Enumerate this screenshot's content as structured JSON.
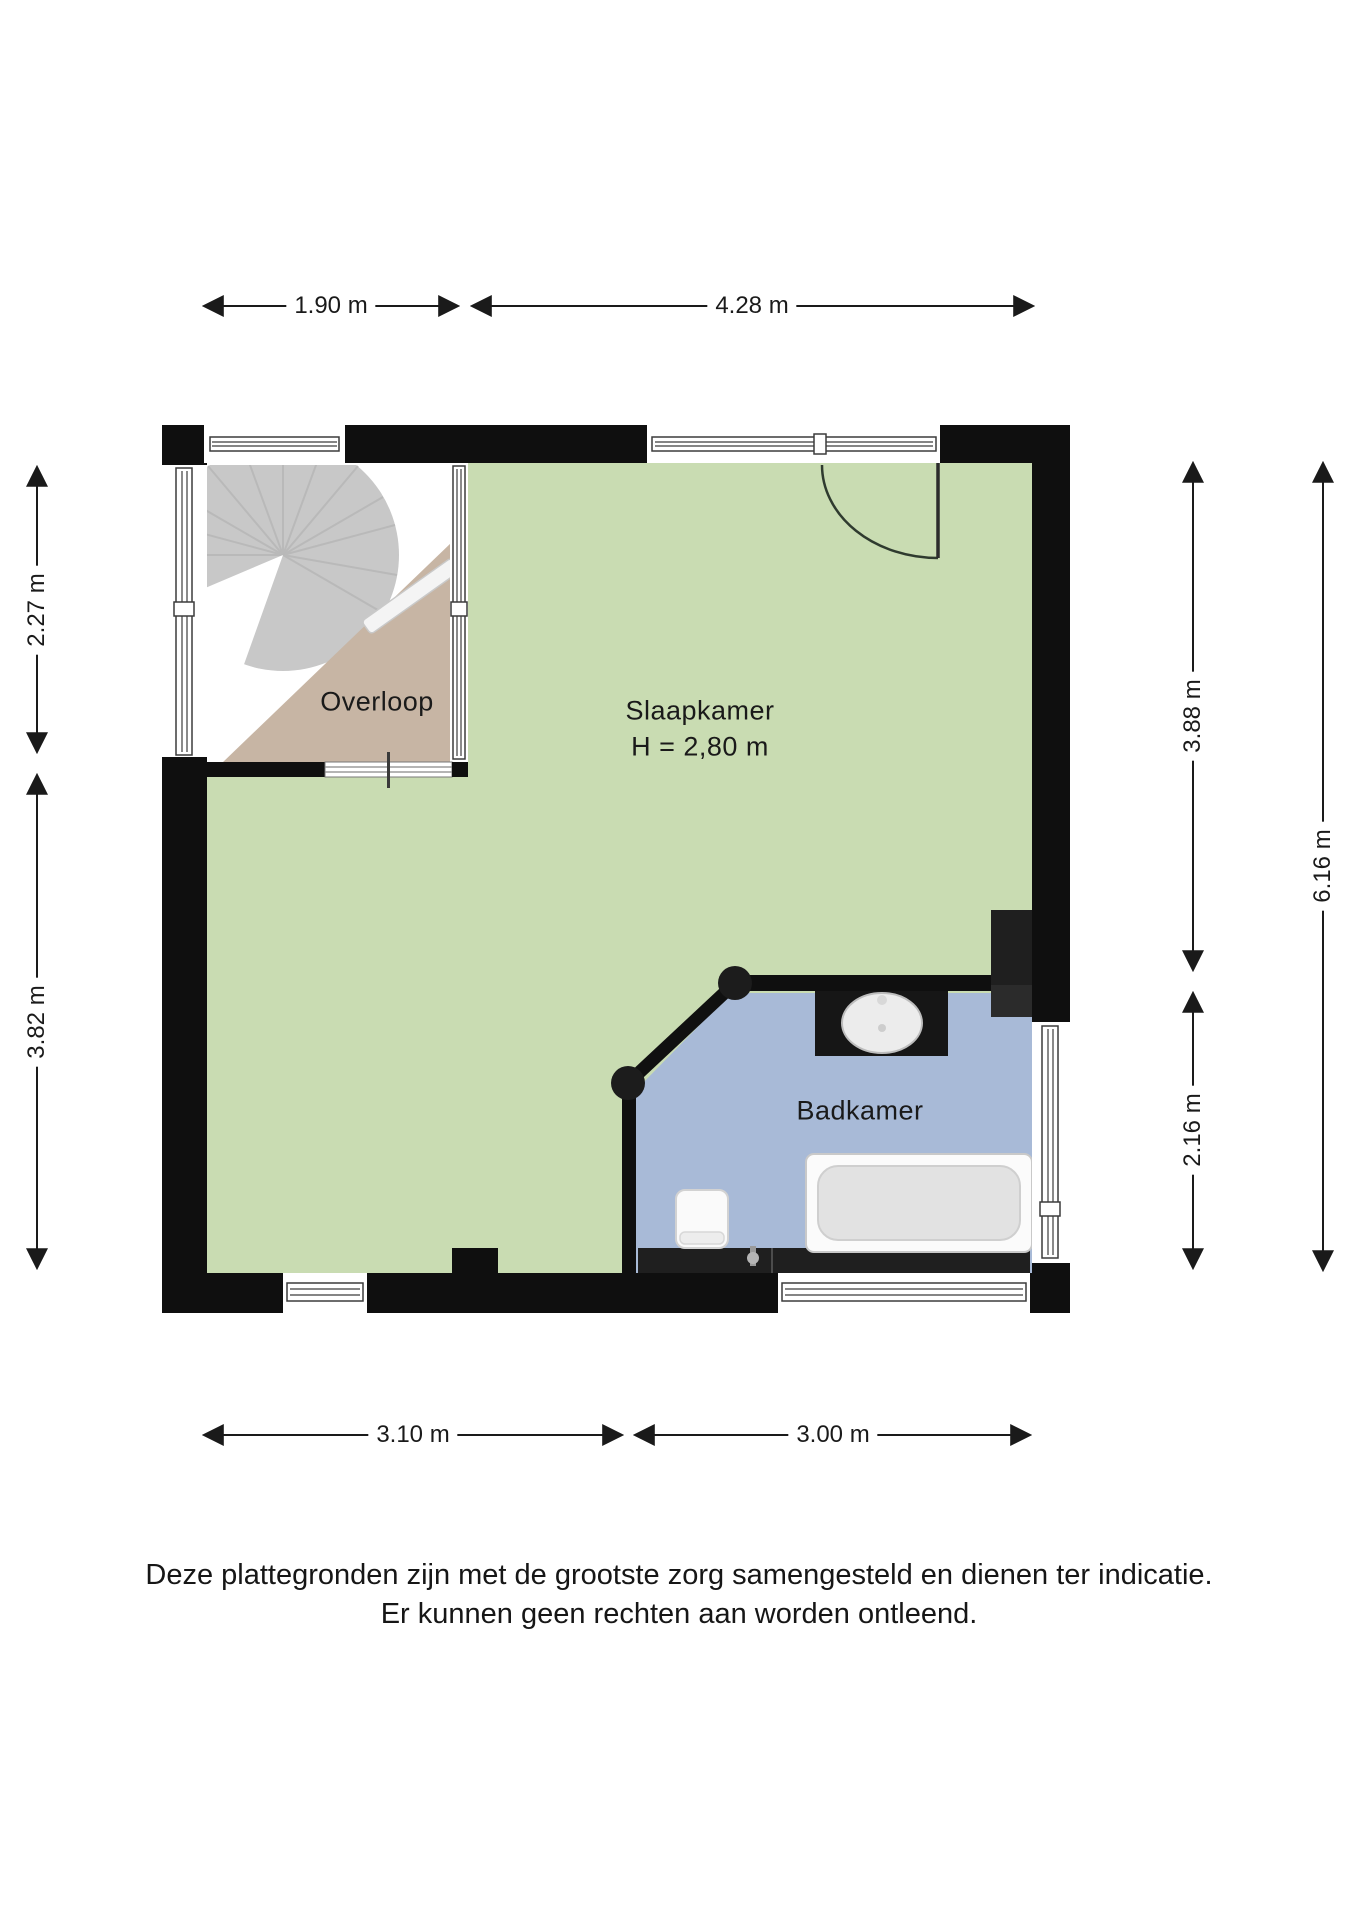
{
  "rooms": [
    {
      "id": "overloop",
      "label": "Overloop"
    },
    {
      "id": "slaapkamer",
      "label": "Slaapkamer",
      "ceiling_height": "H = 2,80 m"
    },
    {
      "id": "badkamer",
      "label": "Badkamer"
    }
  ],
  "dimensions": {
    "top": [
      {
        "label": "1.90 m"
      },
      {
        "label": "4.28 m"
      }
    ],
    "left": [
      {
        "label": "2.27 m"
      },
      {
        "label": "3.82 m"
      }
    ],
    "right": [
      {
        "label": "3.88 m"
      },
      {
        "label": "2.16 m"
      },
      {
        "label": "6.16 m"
      }
    ],
    "bottom": [
      {
        "label": "3.10 m"
      },
      {
        "label": "3.00 m"
      }
    ]
  },
  "disclaimer": {
    "line1": "Deze plattegronden zijn met de grootste zorg samengesteld en dienen ter indicatie.",
    "line2": "Er kunnen geen rechten aan worden ontleend."
  },
  "colors": {
    "bedroom_floor": "#c9dcb2",
    "bathroom_floor": "#a8bad7",
    "landing_floor": "#c7b5a4",
    "stair_gray": "#c8c8c8",
    "wall": "#0f0f0f",
    "counter_black": "#161616",
    "ledge_black": "#1f1f1f",
    "dim_line": "#1a1a1a"
  },
  "fixtures": [
    {
      "name": "spiral-staircase"
    },
    {
      "name": "entry-door"
    },
    {
      "name": "washbasin"
    },
    {
      "name": "toilet"
    },
    {
      "name": "bathtub"
    },
    {
      "name": "faucet"
    }
  ]
}
